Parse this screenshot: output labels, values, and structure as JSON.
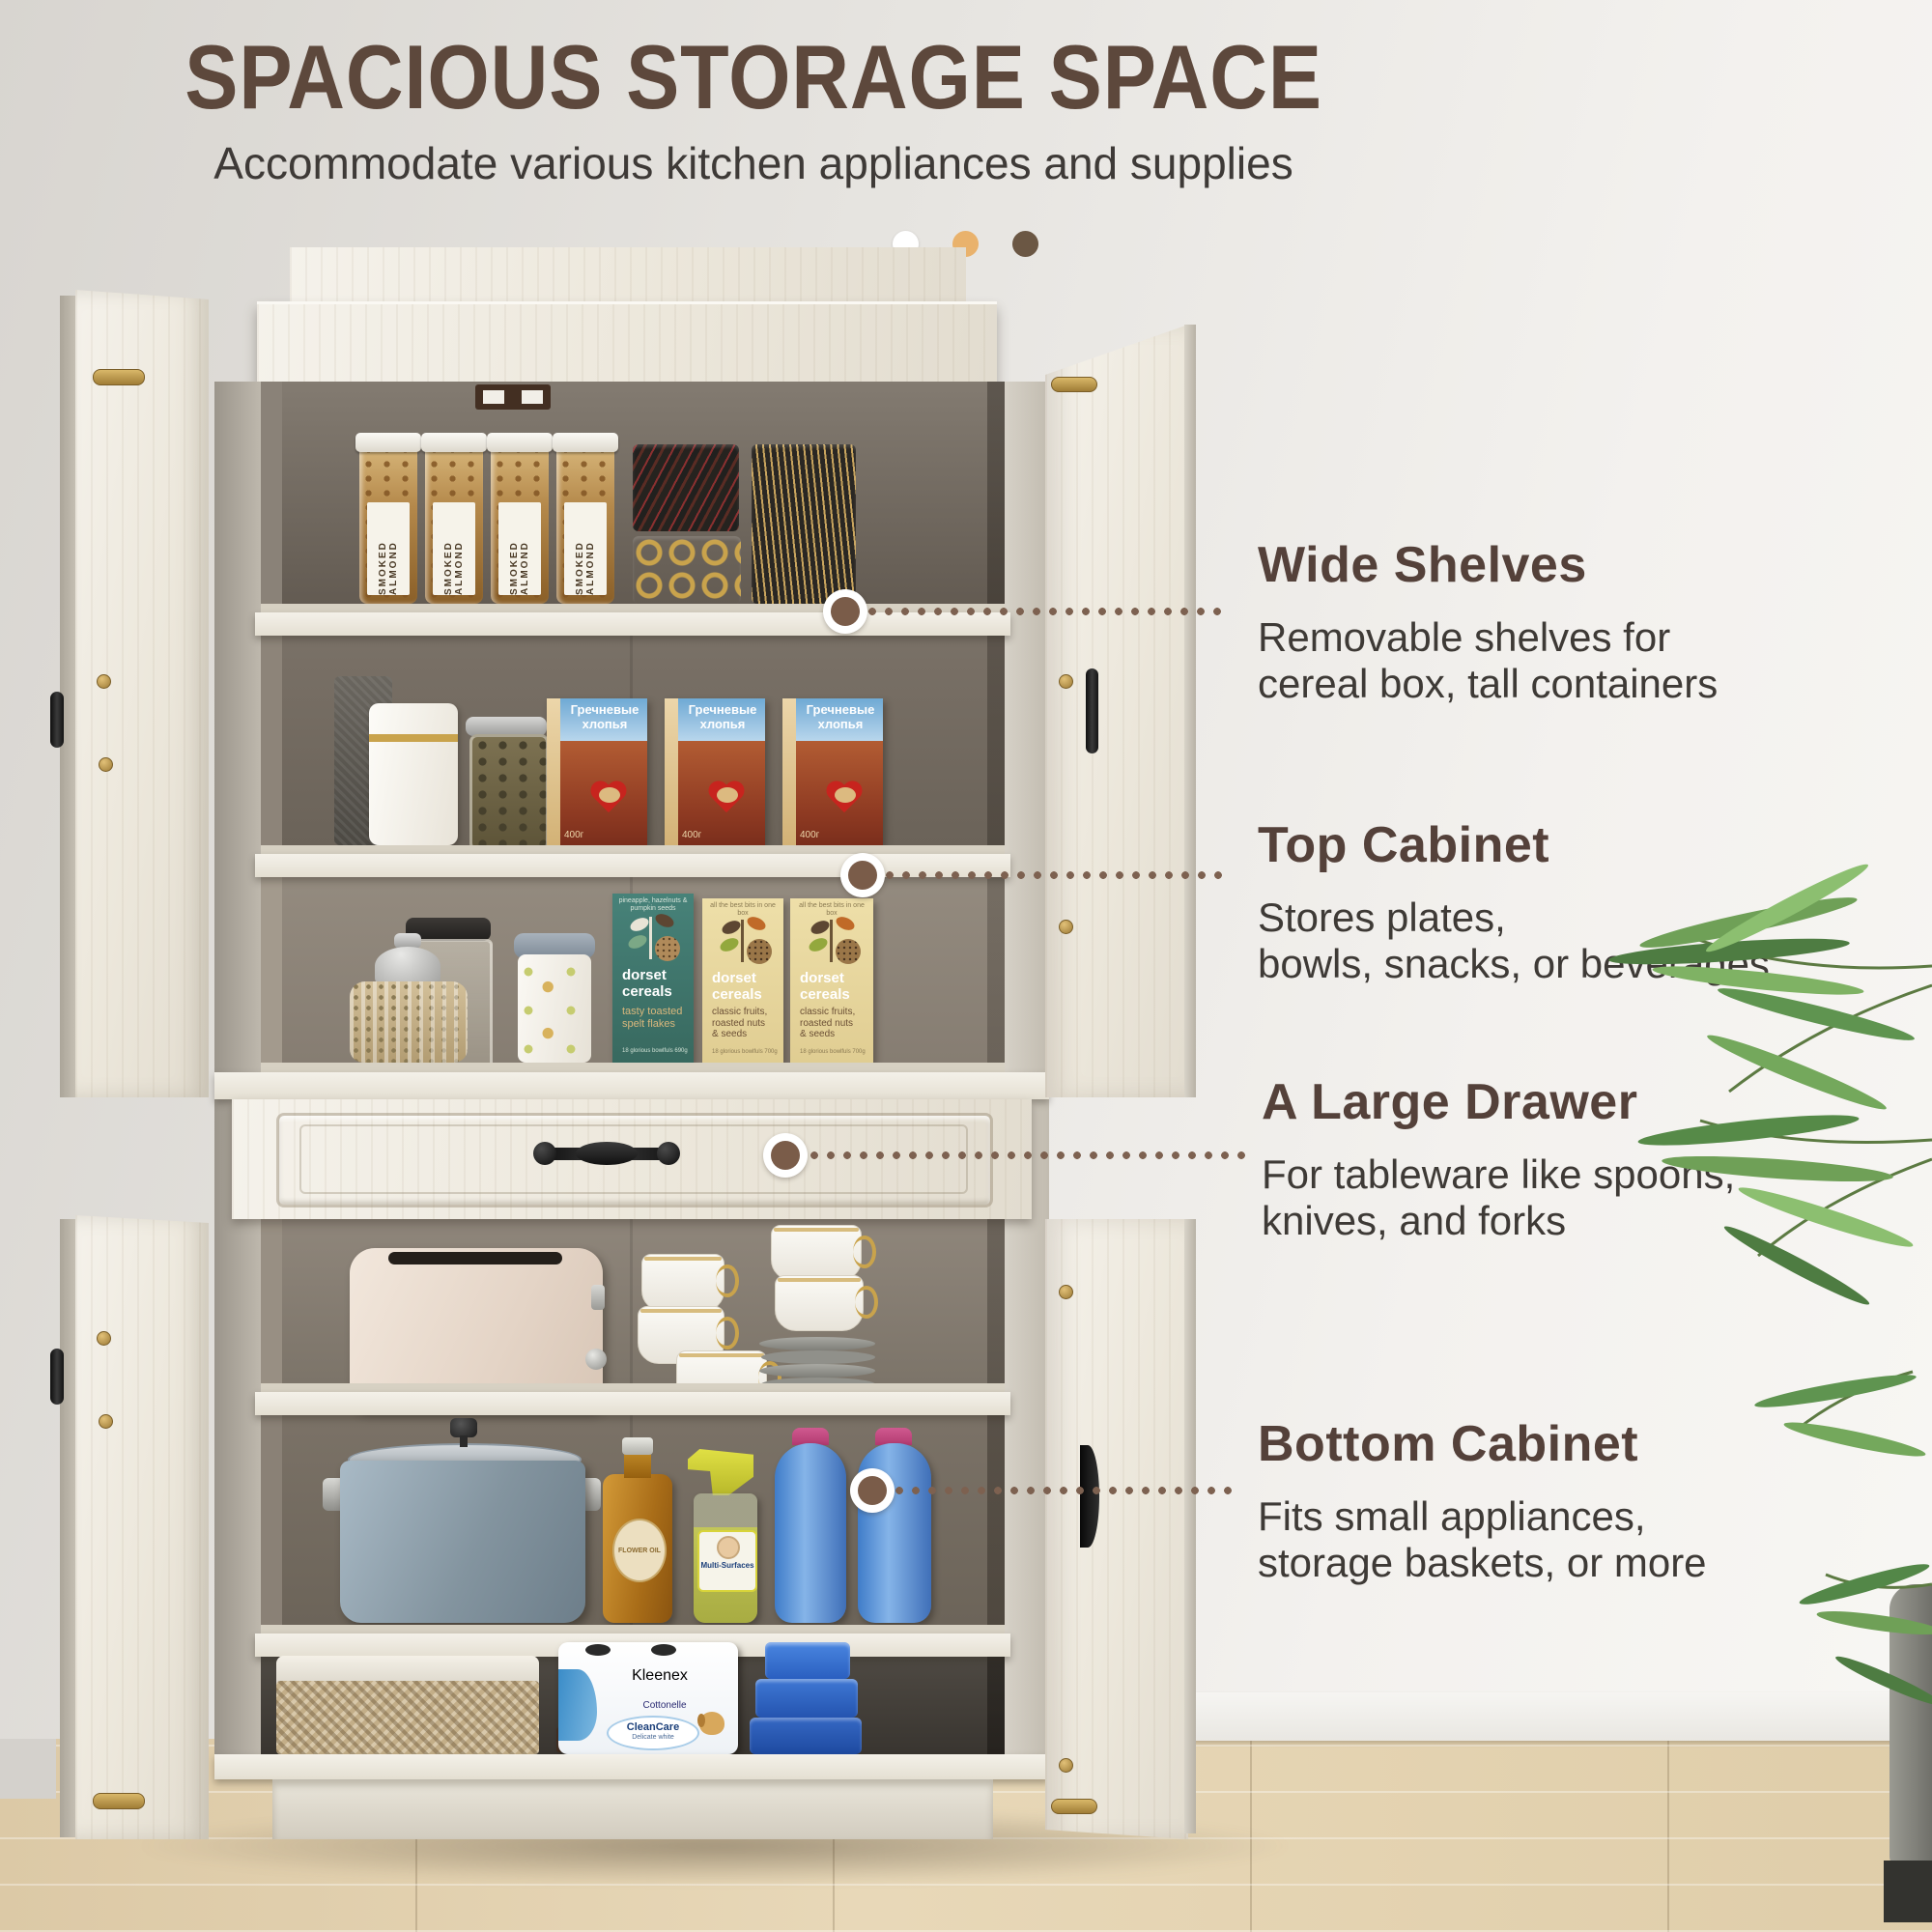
{
  "header": {
    "title": "SPACIOUS STORAGE SPACE",
    "subtitle": "Accommodate various kitchen appliances and supplies"
  },
  "pager": {
    "colors": [
      "#ffffff",
      "#e9b26c",
      "#6b5744"
    ]
  },
  "callouts": [
    {
      "heading": "Wide Shelves",
      "line1": "Removable shelves for",
      "line2": "cereal box, tall containers"
    },
    {
      "heading": "Top Cabinet",
      "line1": "Stores plates,",
      "line2": "bowls, snacks, or beverages"
    },
    {
      "heading": "A Large Drawer",
      "line1": "For tableware like spoons,",
      "line2": "knives, and forks"
    },
    {
      "heading": "Bottom Cabinet",
      "line1": "Fits small appliances,",
      "line2": "storage baskets, or more"
    }
  ],
  "products": {
    "almond_label": "SMOKED ALMOND",
    "ru_cereal_line1": "Гречневые",
    "ru_cereal_line2": "хлопья",
    "ru_cereal_weight": "400г",
    "dorset_brand_l1": "dorset",
    "dorset_brand_l2": "cereals",
    "dorset_green_top": "pineapple, hazelnuts & pumpkin seeds",
    "dorset_green_v1": "tasty toasted",
    "dorset_green_v2": "spelt flakes",
    "dorset_green_bottom": "18 glorious bowlfuls 690g",
    "dorset_cream_top": "all the best bits in one box",
    "dorset_cream_v1": "classic fruits,",
    "dorset_cream_v2": "roasted nuts",
    "dorset_cream_v3": "& seeds",
    "dorset_cream_bottom": "18 glorious bowlfuls 700g",
    "spray_label": "Multi-Surfaces",
    "oil_label": "FLOWER OIL",
    "kleenex_brand": "Kleenex",
    "kleenex_sub": "Cottonelle",
    "kleenex_line1": "CleanCare",
    "kleenex_line2": "Delicate white"
  },
  "colors": {
    "accent_brown": "#5d483c",
    "dotline": "#7d6150",
    "wall": "#e6e4e0",
    "floor": "#e2d1ae"
  }
}
